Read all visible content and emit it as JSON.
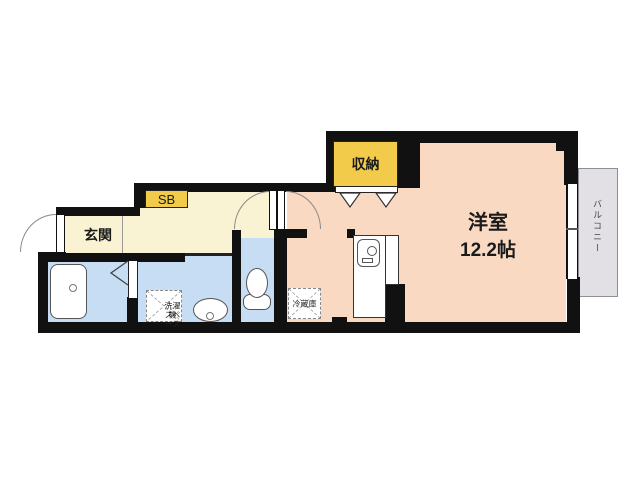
{
  "plan": {
    "type": "apartment-floor-plan",
    "labels": {
      "genkan": "玄関",
      "shoe_box": "SB",
      "closet": "収納",
      "main_room_name": "洋室",
      "main_room_size": "12.2帖",
      "washer_line1": "洗濯機",
      "washer_line2": "スペース",
      "fridge": "冷蔵庫",
      "balcony": "バルコニー"
    },
    "colors": {
      "wall": "#111111",
      "room_main": "#f9d9c2",
      "room_hall": "#faf3d3",
      "room_wet": "#c6ddf3",
      "cabinet": "#f2cb4b",
      "balcony_fill": "#e2e0e4",
      "balcony_border": "#8f8f93",
      "fixture_border": "#555555"
    }
  }
}
